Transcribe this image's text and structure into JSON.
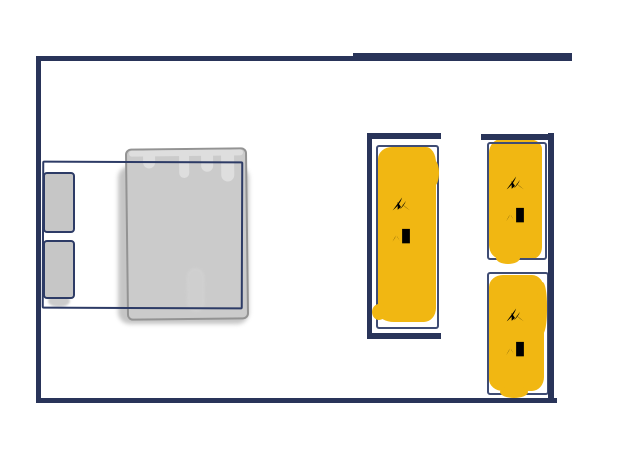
{
  "canvas": {
    "kind": "hand-drawn bedroom floor plan",
    "background": "#ffffff"
  },
  "colors": {
    "wall_navy": "#293459",
    "sketch_outline_blue": "#3f4c74",
    "frame_navy": "#2d3b66",
    "label_ink": "#2b3a66",
    "wardrobe_yellow": "#f1b712",
    "mattress_gray": "#cbcbcb",
    "mattress_edge_gray": "#939393",
    "pillow_gray": "#c6c6c6"
  },
  "bed": {
    "pillow_count": 2,
    "parts": [
      "bed-frame",
      "pillow",
      "pillow",
      "mattress"
    ]
  },
  "wardrobes": [
    {
      "id": "wardrobe-left-tall",
      "label": "衣柜",
      "chars": [
        "衣",
        "柜"
      ]
    },
    {
      "id": "wardrobe-top-right",
      "label": "衣柜",
      "chars": [
        "衣",
        "柜"
      ]
    },
    {
      "id": "wardrobe-bottom-right",
      "label": "衣柜",
      "chars": [
        "衣",
        "柜"
      ]
    }
  ],
  "icons": {
    "yi_char": "yi-clothes-character-icon",
    "gui_char": "gui-cabinet-character-icon"
  }
}
